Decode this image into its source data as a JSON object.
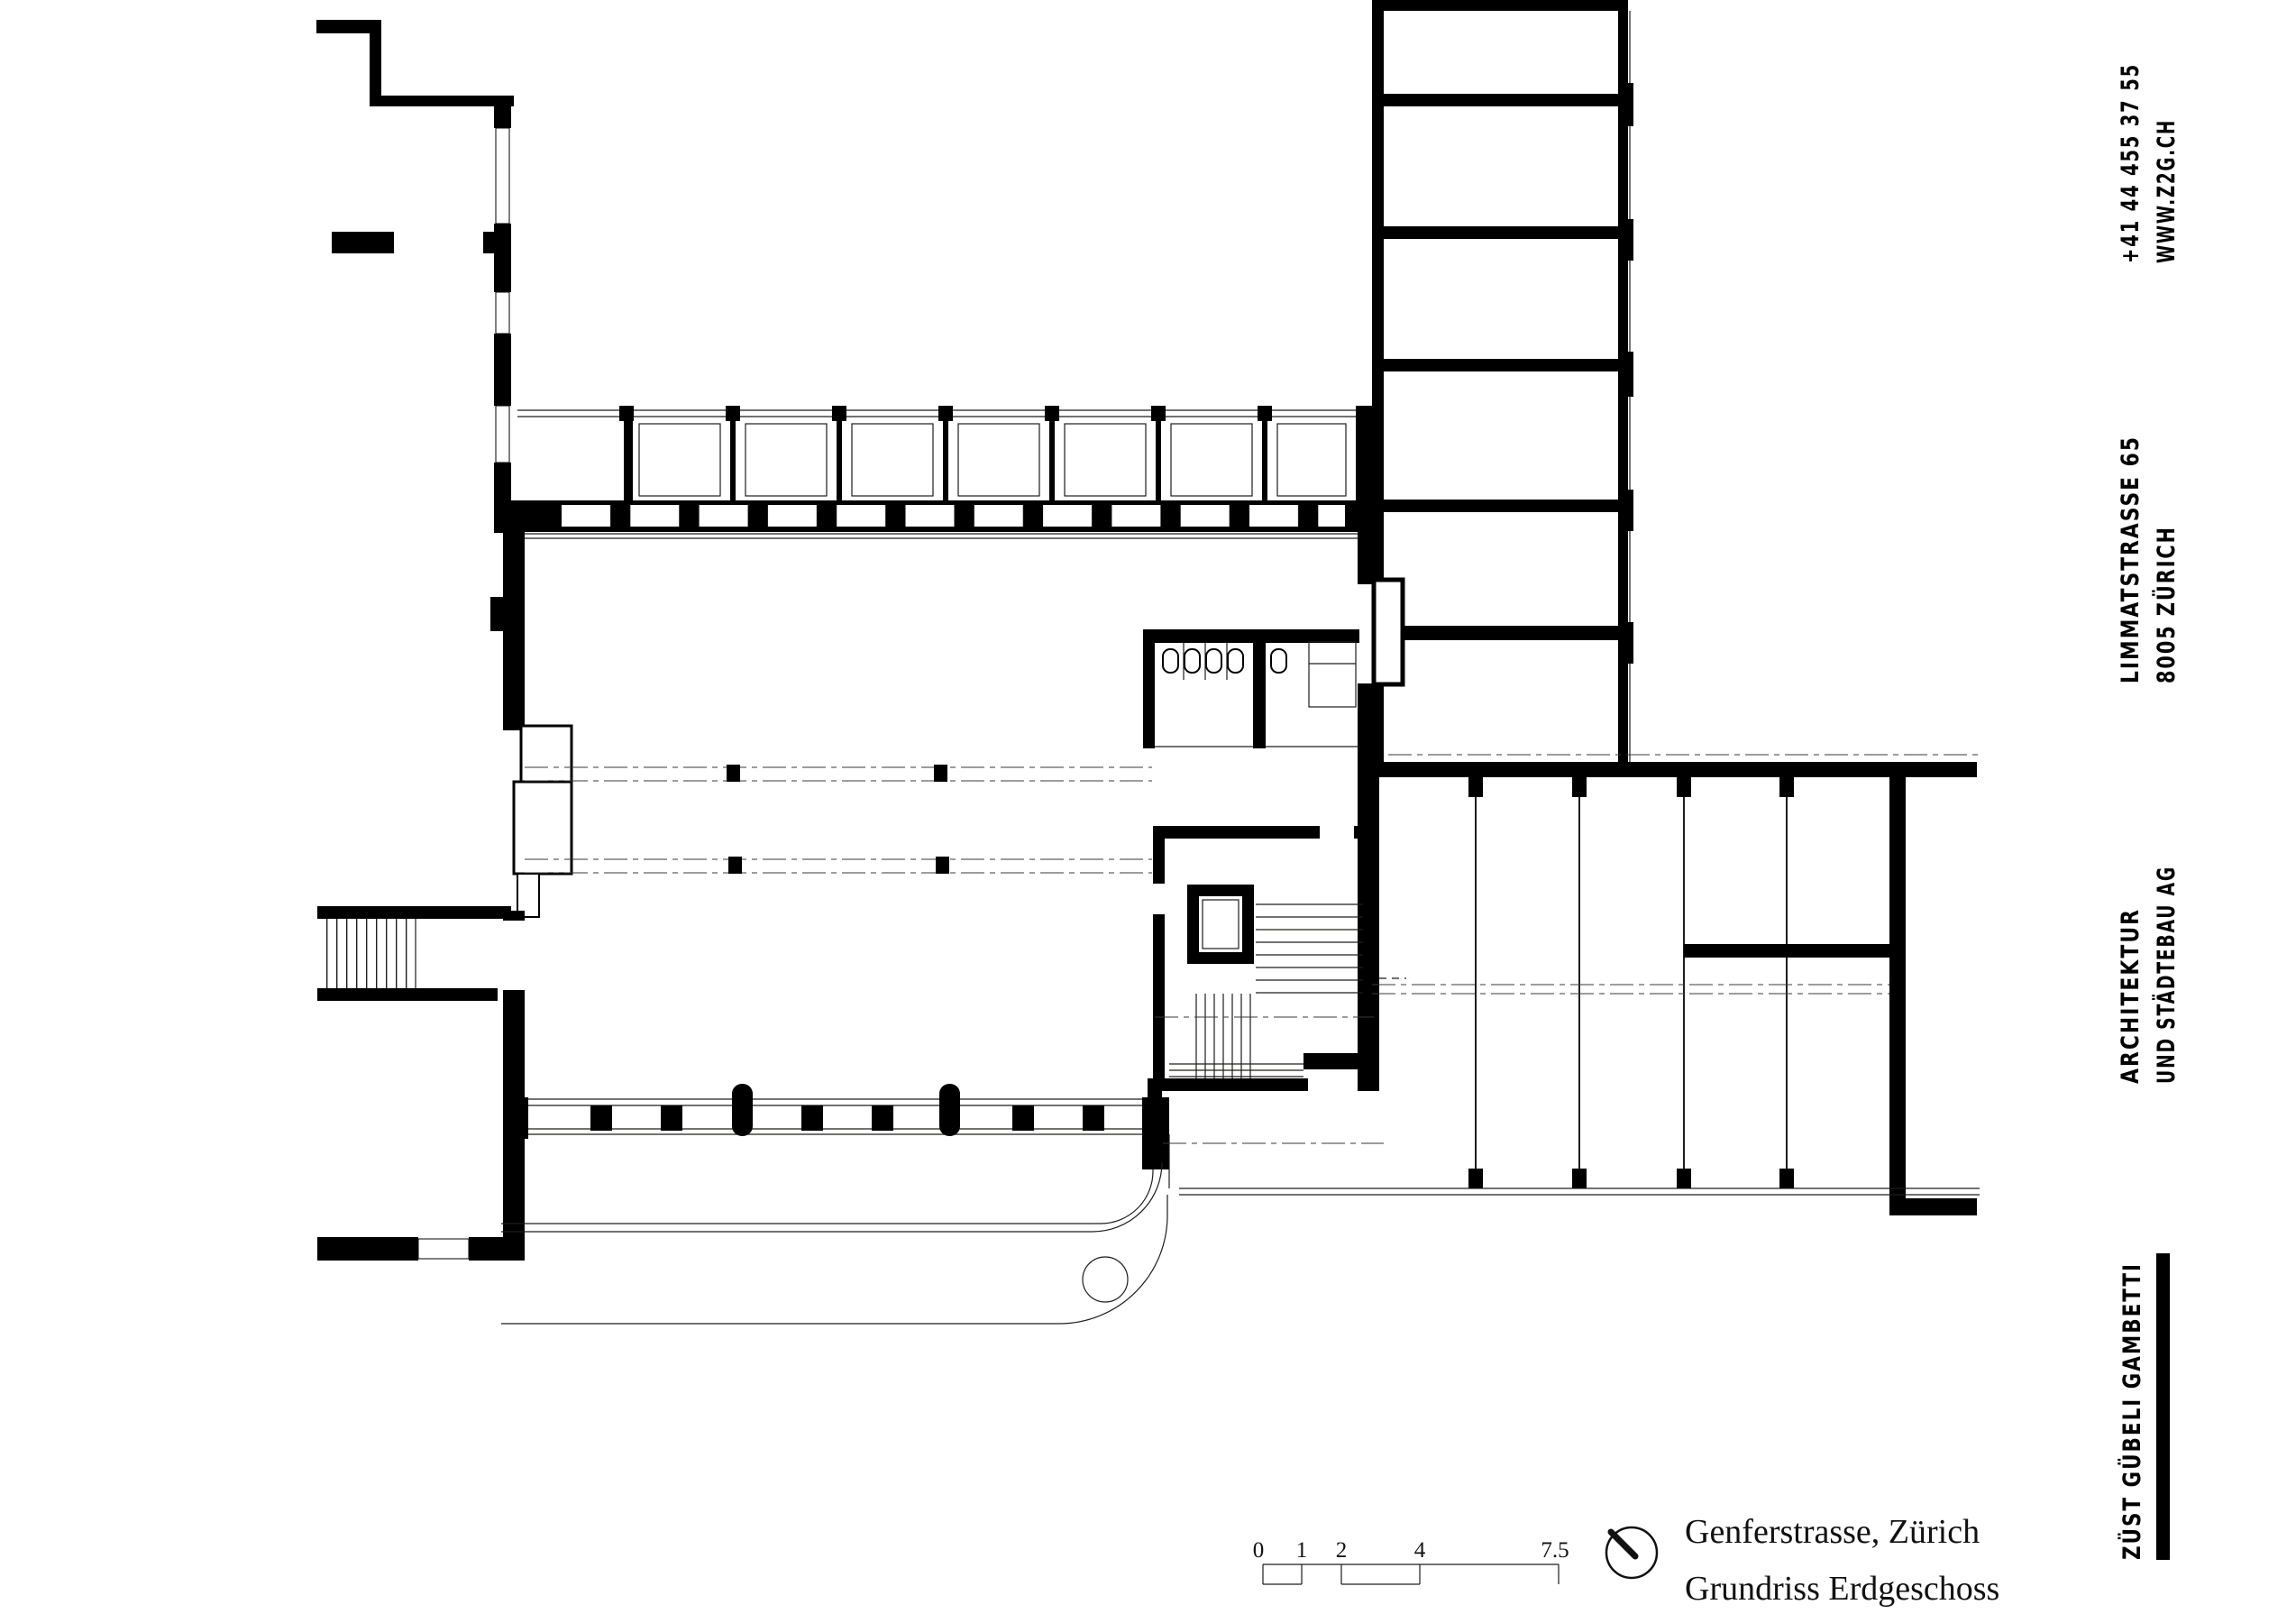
{
  "document": {
    "kind": "architectural floor plan sheet",
    "paper_color": "#ffffff",
    "ink_color": "#000000"
  },
  "title_block": {
    "project": "Genferstrasse, Zürich",
    "drawing": "Grundriss Erdgeschoss"
  },
  "scale_bar": {
    "labels": [
      "0",
      "1",
      "2",
      "4",
      "7.5"
    ]
  },
  "icons": {
    "north": "north-indicator"
  },
  "firm": {
    "name": "ZÜST GÜBELI GAMBETTI",
    "discipline_line1": "ARCHITEKTUR",
    "discipline_line2": "UND STÄDTEBAU AG",
    "address_line1": "LIMMATSTRASSE 65",
    "address_line2": "8005 ZÜRICH",
    "phone": "+41 44 455 37 55",
    "website": "WWW.Z2G.CH"
  },
  "colors": {
    "ink": "#000000",
    "thin_line": "#1d1d1b",
    "paper": "#ffffff"
  }
}
